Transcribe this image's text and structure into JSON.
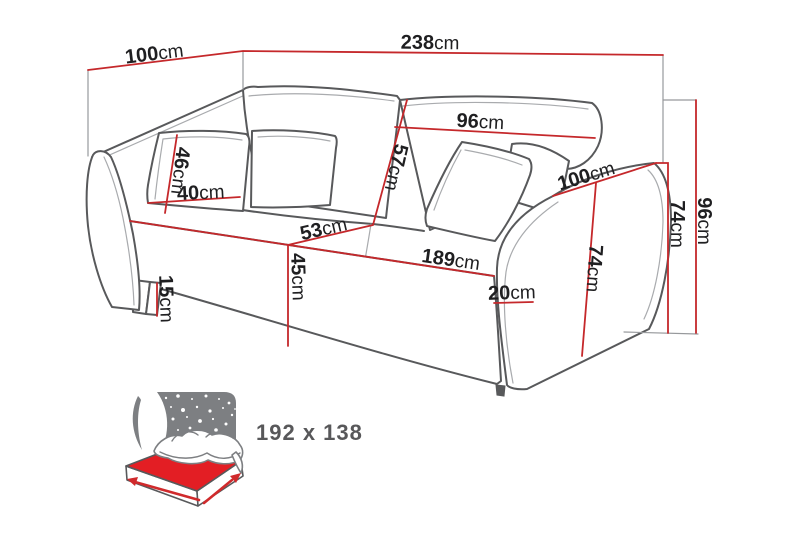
{
  "diagram_type": "sofa-bed dimension drawing",
  "unit_default": "cm",
  "labels": {
    "depth_top": {
      "value": "100",
      "unit": "cm"
    },
    "total_width": {
      "value": "238",
      "unit": "cm"
    },
    "back_cushion_width": {
      "value": "96",
      "unit": "cm"
    },
    "back_cushion_height": {
      "value": "57",
      "unit": "cm"
    },
    "pillow_height": {
      "value": "46",
      "unit": "cm"
    },
    "pillow_width": {
      "value": "40",
      "unit": "cm"
    },
    "seat_depth": {
      "value": "53",
      "unit": "cm"
    },
    "seat_width": {
      "value": "189",
      "unit": "cm"
    },
    "seat_height": {
      "value": "45",
      "unit": "cm"
    },
    "leg_height": {
      "value": "15",
      "unit": "cm"
    },
    "armrest_front_width": {
      "value": "20",
      "unit": "cm"
    },
    "armrest_depth": {
      "value": "100",
      "unit": "cm"
    },
    "armrest_height_front": {
      "value": "74",
      "unit": "cm"
    },
    "armrest_height_side": {
      "value": "74",
      "unit": "cm"
    },
    "total_height": {
      "value": "96",
      "unit": "cm"
    }
  },
  "sleeping_area": {
    "label": "192 x 138"
  },
  "colors": {
    "dim_red": "#c5282b",
    "sofa_outline": "#58595b",
    "sofa_line_light": "#a9abae",
    "ext_gray": "#97999c",
    "icon_gray": "#7d7f82",
    "mattress_red": "#e31e24",
    "arrow_red": "#d02a2c",
    "label_black": "#1f1f21",
    "icon_text": "#58585a",
    "bg": "#ffffff"
  }
}
